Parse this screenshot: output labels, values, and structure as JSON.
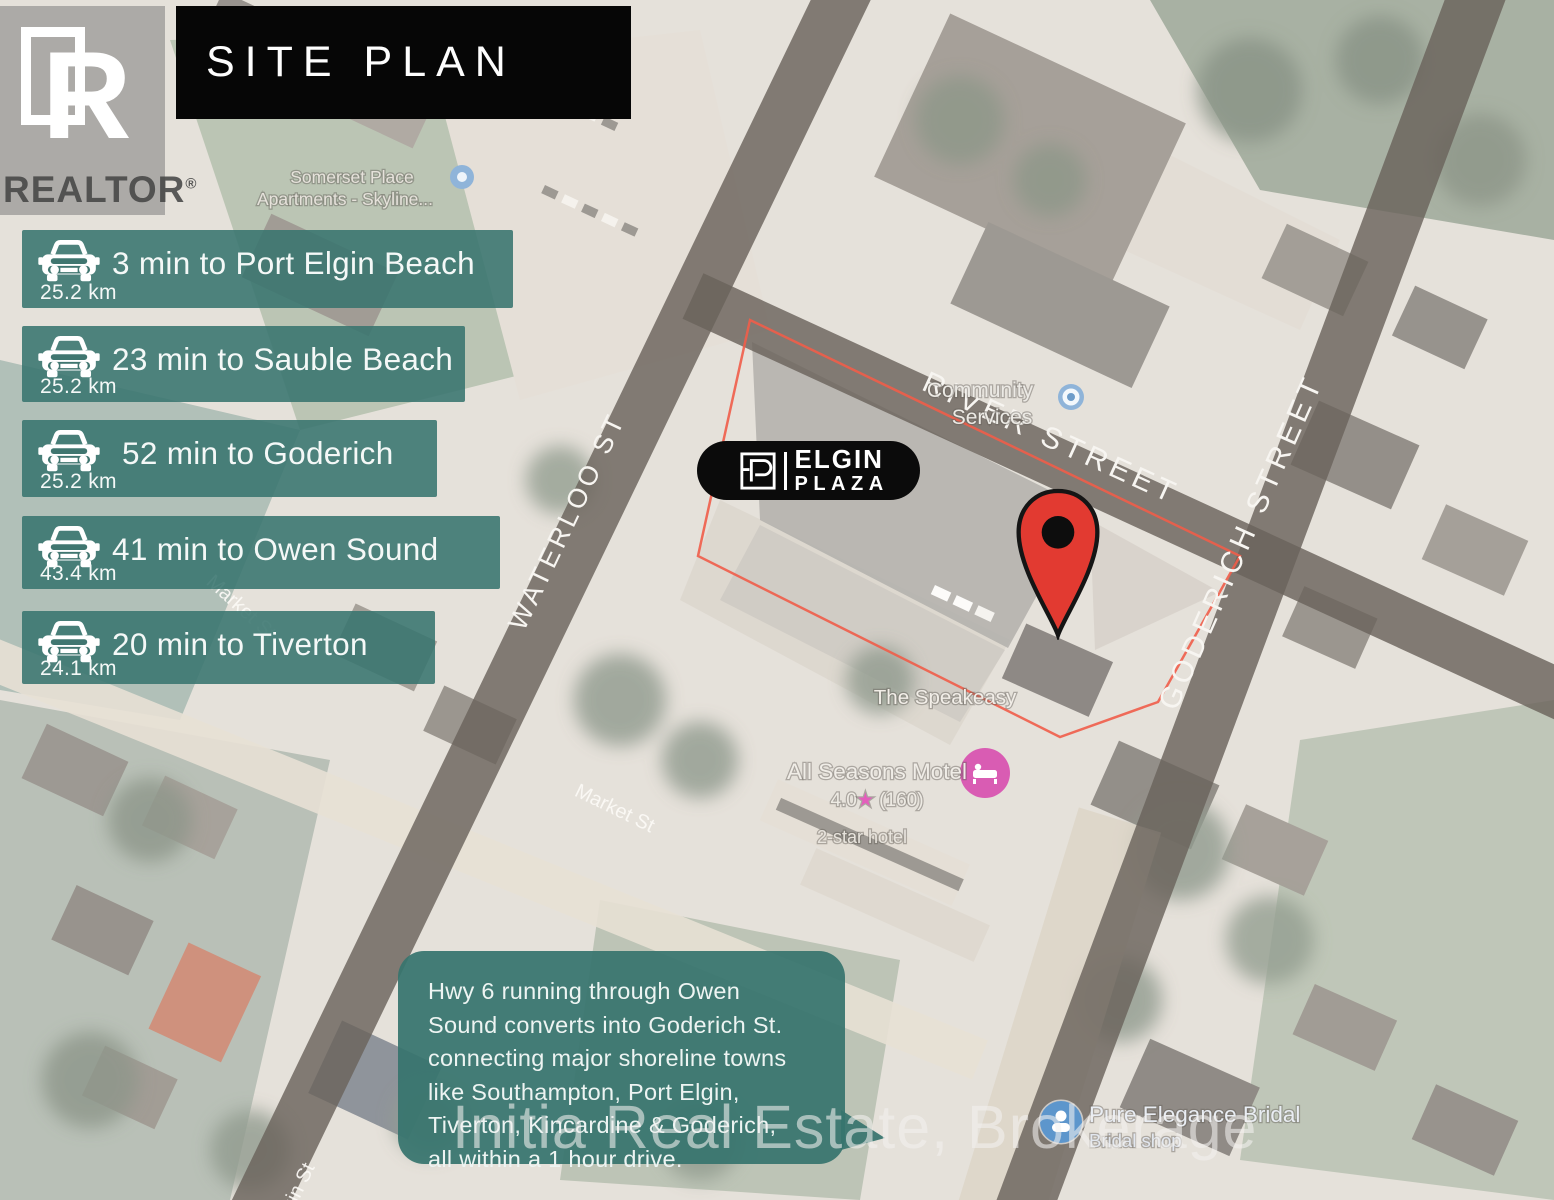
{
  "header": {
    "title": "SITE PLAN"
  },
  "branding": {
    "name": "REALTOR",
    "mark": "®"
  },
  "drive_times": [
    {
      "label": "3 min to Port Elgin Beach",
      "distance": "25.2 km"
    },
    {
      "label": "23 min to Sauble Beach",
      "distance": "25.2 km"
    },
    {
      "label": "52 min to Goderich",
      "distance": "25.2 km"
    },
    {
      "label": "41 min to Owen Sound",
      "distance": "43.4 km"
    },
    {
      "label": "20 min to Tiverton",
      "distance": "24.1 km"
    }
  ],
  "plaza_badge": {
    "line1": "ELGIN",
    "line2": "PLAZA"
  },
  "map": {
    "streets": {
      "waterloo": "WATERLOO ST",
      "river": "RIVER STREET",
      "goderich": "GODERICH STREET",
      "market_upper": "Market St",
      "market_lower": "Market St",
      "elgin": "Elgin St"
    },
    "pois": {
      "somerset_line1": "Somerset Place",
      "somerset_line2": "Apartments - Skyline...",
      "community_line1": "Community",
      "community_line2": "Services",
      "speakeasy": "The Speakeasy",
      "motel_name": "All Seasons Motel",
      "motel_rating": "4.0",
      "motel_star": "★",
      "motel_reviews": " (160)",
      "motel_type": "2-star hotel",
      "bridal_name": "Pure Elegance Bridal",
      "bridal_type": "Bridal shop"
    }
  },
  "callout": {
    "text": "Hwy 6 running through Owen\nSound converts into Goderich St.\nconnecting major shoreline towns\nlike Southampton, Port Elgin,\nTiverton, Kincardine & Goderich,\nall within a 1 hour drive."
  },
  "watermark": {
    "text": "Initia Real Estate, Brokerage"
  },
  "colors": {
    "accent_teal": "#38746E",
    "banner_black": "#060606",
    "pin_red": "#E23A31",
    "parcel_outline_red": "#EF5D49",
    "road_gray": "#6C6158",
    "poi_blue": "#8FB4D9",
    "hotel_pink": "#D95CB3"
  }
}
